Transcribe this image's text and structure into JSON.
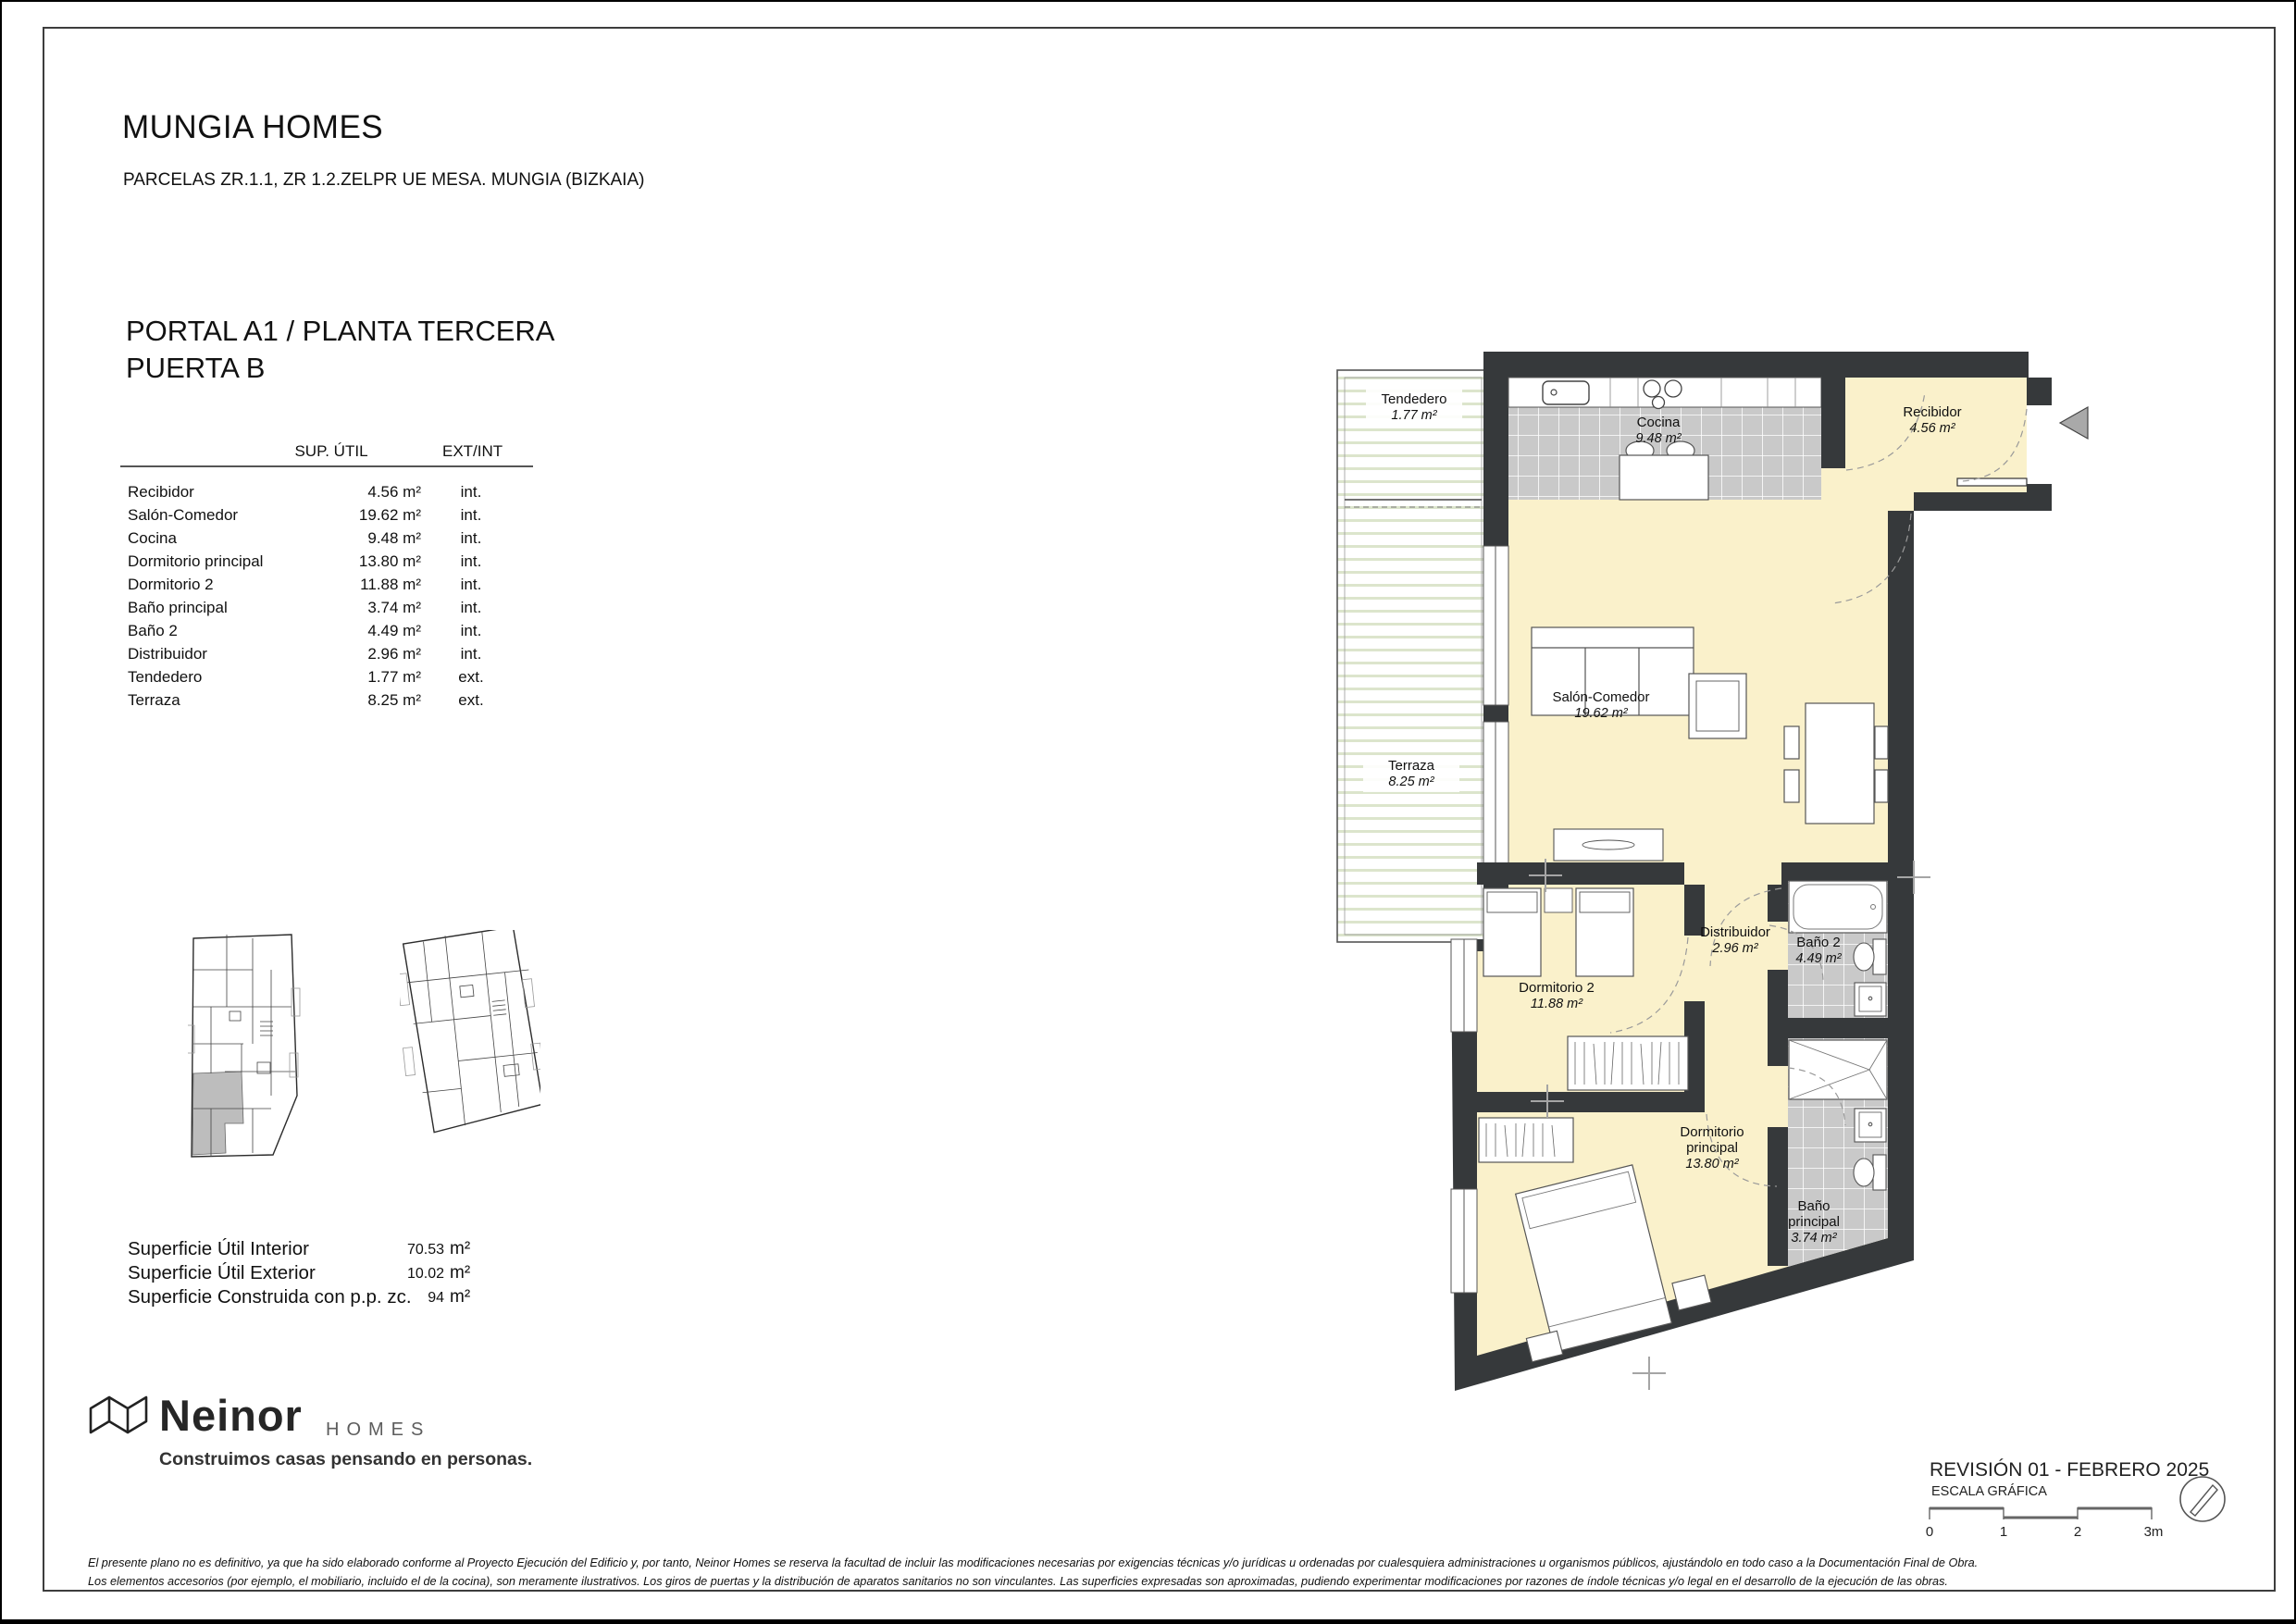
{
  "header": {
    "title": "MUNGIA HOMES",
    "subtitle": "PARCELAS ZR.1.1, ZR 1.2.ZELPR UE MESA. MUNGIA (BIZKAIA)",
    "portal": "PORTAL A1 / PLANTA TERCERA\nPUERTA B"
  },
  "table": {
    "col_sup": "SUP. ÚTIL",
    "col_ext": "EXT/INT",
    "rows": [
      {
        "name": "Recibidor",
        "sup": "4.56 m²",
        "ext": "int."
      },
      {
        "name": "Salón-Comedor",
        "sup": "19.62 m²",
        "ext": "int."
      },
      {
        "name": "Cocina",
        "sup": "9.48 m²",
        "ext": "int."
      },
      {
        "name": "Dormitorio principal",
        "sup": "13.80 m²",
        "ext": "int."
      },
      {
        "name": "Dormitorio 2",
        "sup": "11.88 m²",
        "ext": "int."
      },
      {
        "name": "Baño principal",
        "sup": "3.74 m²",
        "ext": "int."
      },
      {
        "name": "Baño 2",
        "sup": "4.49 m²",
        "ext": "int."
      },
      {
        "name": "Distribuidor",
        "sup": "2.96 m²",
        "ext": "int."
      },
      {
        "name": "Tendedero",
        "sup": "1.77 m²",
        "ext": "ext."
      },
      {
        "name": "Terraza",
        "sup": "8.25 m²",
        "ext": "ext."
      }
    ]
  },
  "summary": {
    "rows": [
      {
        "label": "Superficie Útil Interior",
        "value": "70.53",
        "unit": "m²"
      },
      {
        "label": "Superficie Útil Exterior",
        "value": "10.02",
        "unit": "m²"
      },
      {
        "label": "Superficie Construida con p.p. zc.",
        "value": "94",
        "unit": "m²"
      }
    ]
  },
  "plan": {
    "tendedero": {
      "name": "Tendedero",
      "area": "1.77 m²"
    },
    "terraza": {
      "name": "Terraza",
      "area": "8.25 m²"
    },
    "cocina": {
      "name": "Cocina",
      "area": "9.48 m²"
    },
    "recibidor": {
      "name": "Recibidor",
      "area": "4.56 m²"
    },
    "salon": {
      "name": "Salón-Comedor",
      "area": "19.62 m²"
    },
    "dorm2": {
      "name": "Dormitorio 2",
      "area": "11.88 m²"
    },
    "distribuidor": {
      "name": "Distribuidor",
      "area": "2.96 m²"
    },
    "bano2": {
      "name": "Baño 2",
      "area": "4.49 m²"
    },
    "dormp": {
      "name1": "Dormitorio",
      "name2": "principal",
      "area": "13.80 m²"
    },
    "banop": {
      "name1": "Baño",
      "name2": "principal",
      "area": "3.74 m²"
    }
  },
  "revision": {
    "title": "REVISIÓN 01 - FEBRERO 2025",
    "scale_label": "ESCALA GRÁFICA",
    "ticks": [
      "0",
      "1",
      "2",
      "3m"
    ]
  },
  "logo": {
    "brand": "Neinor",
    "homes": "HOMES",
    "tagline": "Construimos casas pensando en personas."
  },
  "footer": {
    "line1": "El presente plano no es definitivo, ya que ha sido elaborado conforme al Proyecto Ejecución del Edificio y, por tanto, Neinor Homes se reserva la facultad de incluir las modificaciones necesarias por exigencias técnicas y/o jurídicas u ordenadas por cualesquiera administraciones u organismos públicos, ajustándolo en todo caso a la Documentación Final de Obra.",
    "line2": "Los elementos accesorios (por ejemplo, el mobiliario, incluido el de la cocina), son meramente ilustrativos. Los giros de puertas y la distribución de aparatos sanitarios no son vinculantes. Las superficies expresadas son aproximadas, pudiendo experimentar modificaciones por razones de índole técnicas y/o legal en el desarrollo de la ejecución de las obras."
  },
  "colors": {
    "wall": "#36393B",
    "floor_cream": "#FAF1CB",
    "tile_gray": "#C9C9C9",
    "terrace_slat": "#DCE5CC",
    "entry_arrow": "#A9A9A9"
  }
}
